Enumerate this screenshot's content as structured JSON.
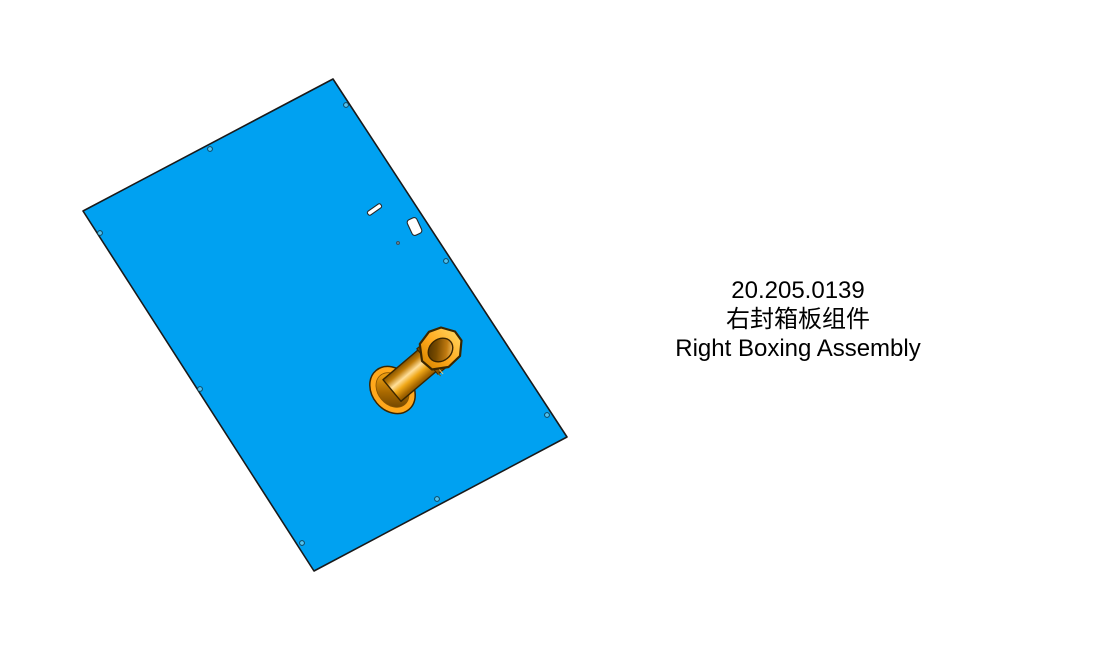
{
  "page": {
    "background": "#ffffff"
  },
  "title_block": {
    "part_number": "20.205.0139",
    "part_name_cn": "右封箱板组件",
    "part_name_en": "Right Boxing Assembly"
  },
  "model": {
    "panel_color": "#00A1F1",
    "panel_outline_color": "#1A1A1A",
    "bushing_color": "#FFA81C",
    "bushing_outline_color": "#3A2600",
    "hole_fill_color": "#53C3F0",
    "hole_outline_color": "#10465F",
    "mounting_hole_count": "8"
  }
}
